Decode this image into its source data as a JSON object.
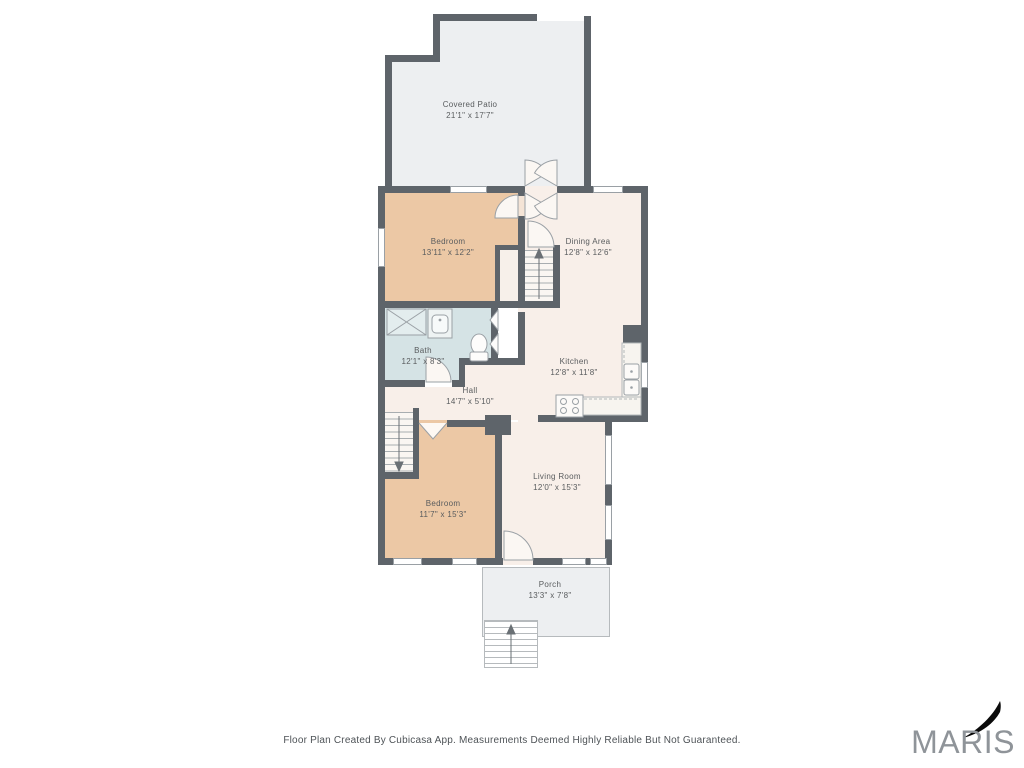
{
  "rooms": [
    {
      "name": "Covered Patio",
      "dims": "21'1\" x 17'7\""
    },
    {
      "name": "Bedroom",
      "dims": "13'11\" x 12'2\""
    },
    {
      "name": "Dining Area",
      "dims": "12'8\" x 12'6\""
    },
    {
      "name": "Bath",
      "dims": "12'1\" x 8'3\""
    },
    {
      "name": "Kitchen",
      "dims": "12'8\" x 11'8\""
    },
    {
      "name": "Hall",
      "dims": "14'7\" x 5'10\""
    },
    {
      "name": "Living Room",
      "dims": "12'0\" x 15'3\""
    },
    {
      "name": "Bedroom",
      "dims": "11'7\" x 15'3\""
    },
    {
      "name": "Porch",
      "dims": "13'3\" x 7'8\""
    }
  ],
  "footer": {
    "text": "Floor Plan Created By Cubicasa App. Measurements Deemed Highly Reliable But Not Guaranteed."
  },
  "logo": {
    "text": "MARIS"
  },
  "colors": {
    "wall": "#5e646a",
    "bedroom_fill": "#ecc8a5",
    "living_dining_fill": "#f8efe9",
    "bath_fill": "#d5e3e5",
    "patio_porch_fill": "#edeff1",
    "label_text": "#595c5e",
    "footer_text": "#4e5357",
    "logo_gray": "#8f9499",
    "logo_arrow": "#0b0b0b"
  }
}
